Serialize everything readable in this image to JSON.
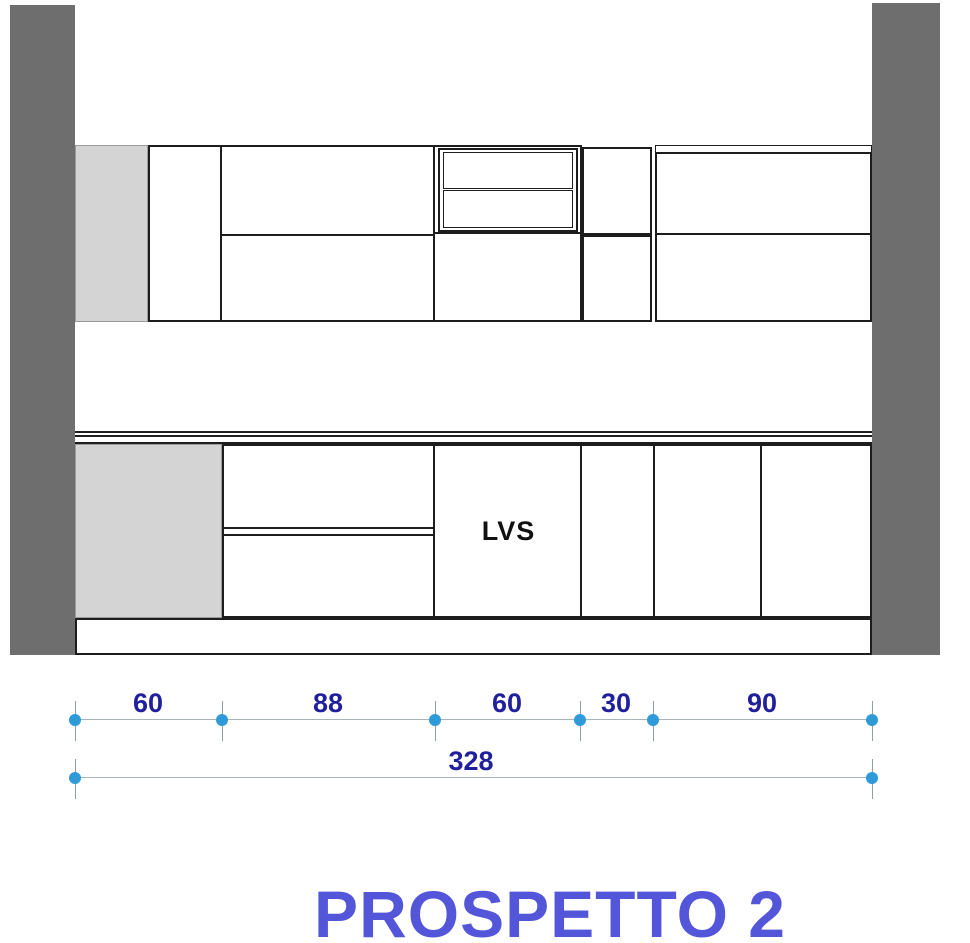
{
  "drawing": {
    "title": "PROSPETTO 2",
    "appliance_label": "LVS"
  },
  "dimensions": {
    "unit_note": "",
    "row": {
      "segments": [
        {
          "value": "60"
        },
        {
          "value": "88"
        },
        {
          "value": "60"
        },
        {
          "value": "30"
        },
        {
          "value": "90"
        }
      ]
    },
    "total": {
      "value": "328"
    }
  },
  "colors": {
    "wall": "#6e6e6e",
    "filler_panel": "#d4d4d4",
    "outline": "#1d1d1d",
    "dimension_line": "#a7b5b8",
    "marker_dot": "#2f9ad8",
    "dimension_text": "#201f9c",
    "title_text": "#5356d8"
  }
}
